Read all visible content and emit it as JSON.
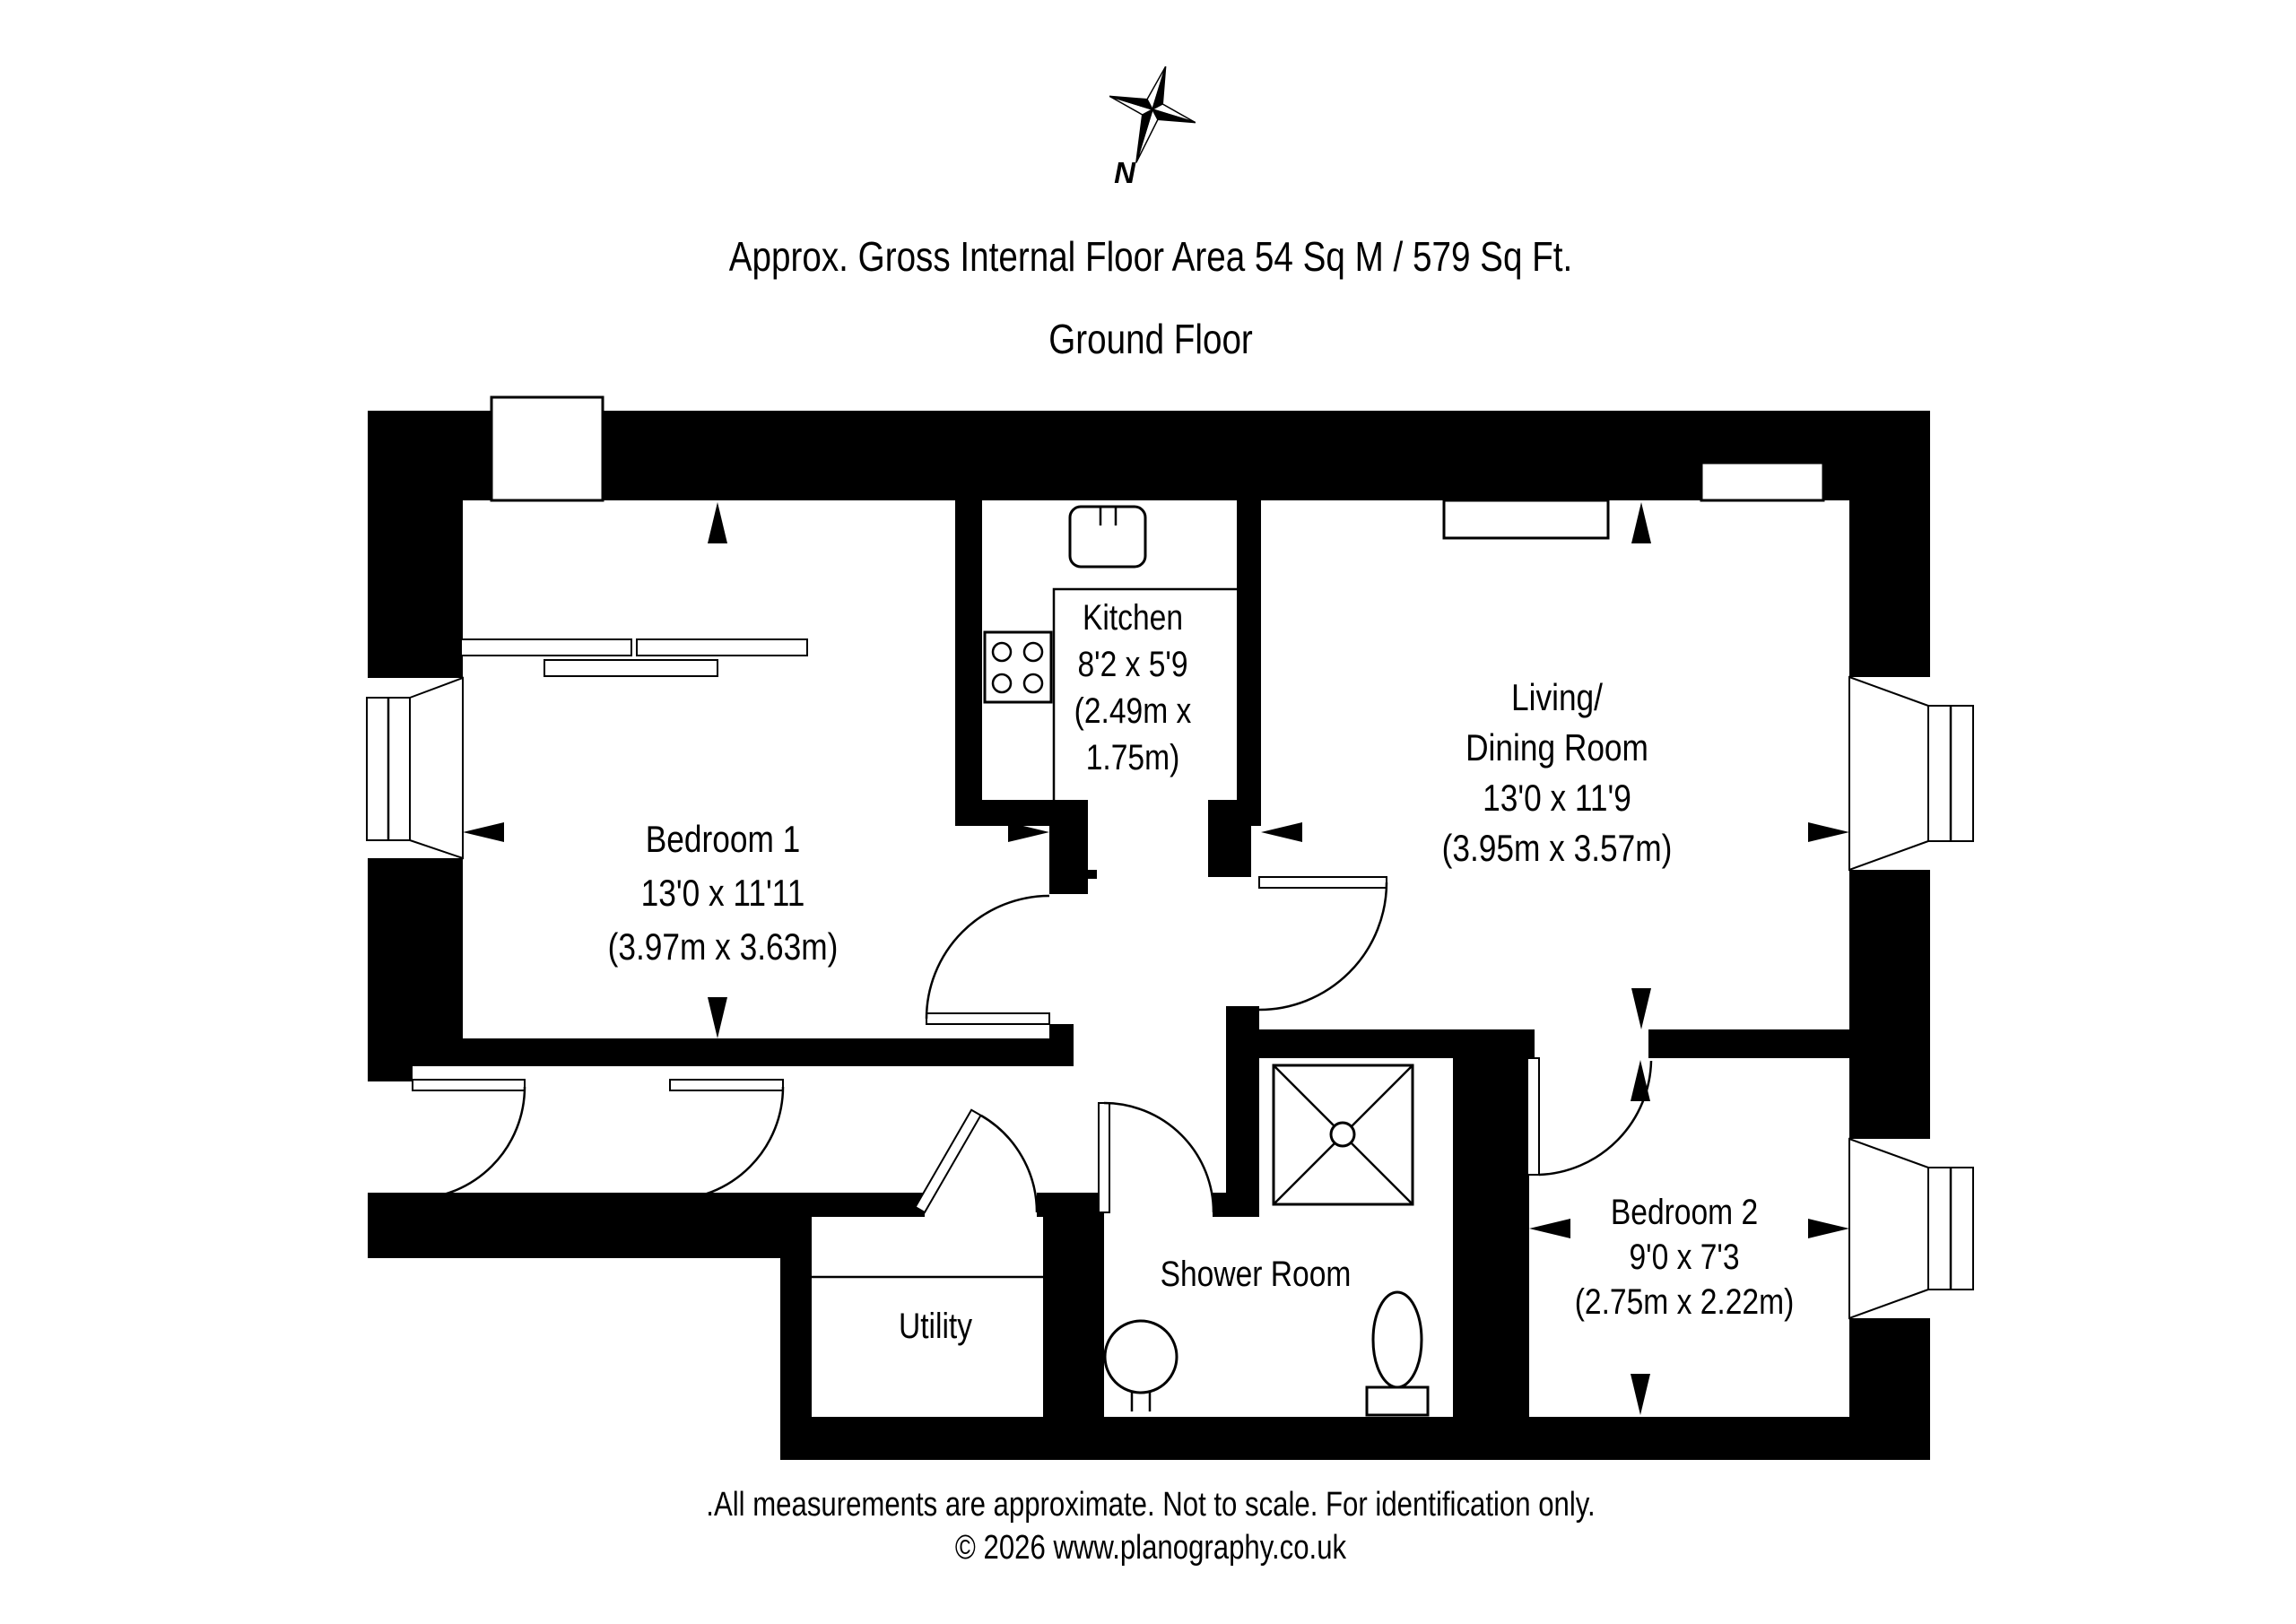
{
  "colors": {
    "walls": "#000000",
    "background": "#ffffff",
    "text": "#000000"
  },
  "header": {
    "area_line": "Approx. Gross Internal Floor Area 54 Sq M / 579 Sq Ft.",
    "floor_title": "Ground Floor"
  },
  "compass": {
    "north_label": "N"
  },
  "rooms": {
    "bedroom1": {
      "name": "Bedroom 1",
      "dims_imperial": "13'0 x 11'11",
      "dims_metric": "(3.97m x 3.63m)"
    },
    "kitchen": {
      "name": "Kitchen",
      "dims_imperial": "8'2 x 5'9",
      "dims_metric_line1": "(2.49m x",
      "dims_metric_line2": "1.75m)"
    },
    "living": {
      "name_line1": "Living/",
      "name_line2": "Dining Room",
      "dims_imperial": "13'0 x 11'9",
      "dims_metric": "(3.95m x 3.57m)"
    },
    "bedroom2": {
      "name": "Bedroom 2",
      "dims_imperial": "9'0 x 7'3",
      "dims_metric": "(2.75m x 2.22m)"
    },
    "shower_room": {
      "name": "Shower Room"
    },
    "utility": {
      "name": "Utility"
    }
  },
  "footer": {
    "disclaimer": ".All measurements are approximate. Not to scale. For identification only.",
    "copyright": "© 2026 www.planography.co.uk"
  }
}
